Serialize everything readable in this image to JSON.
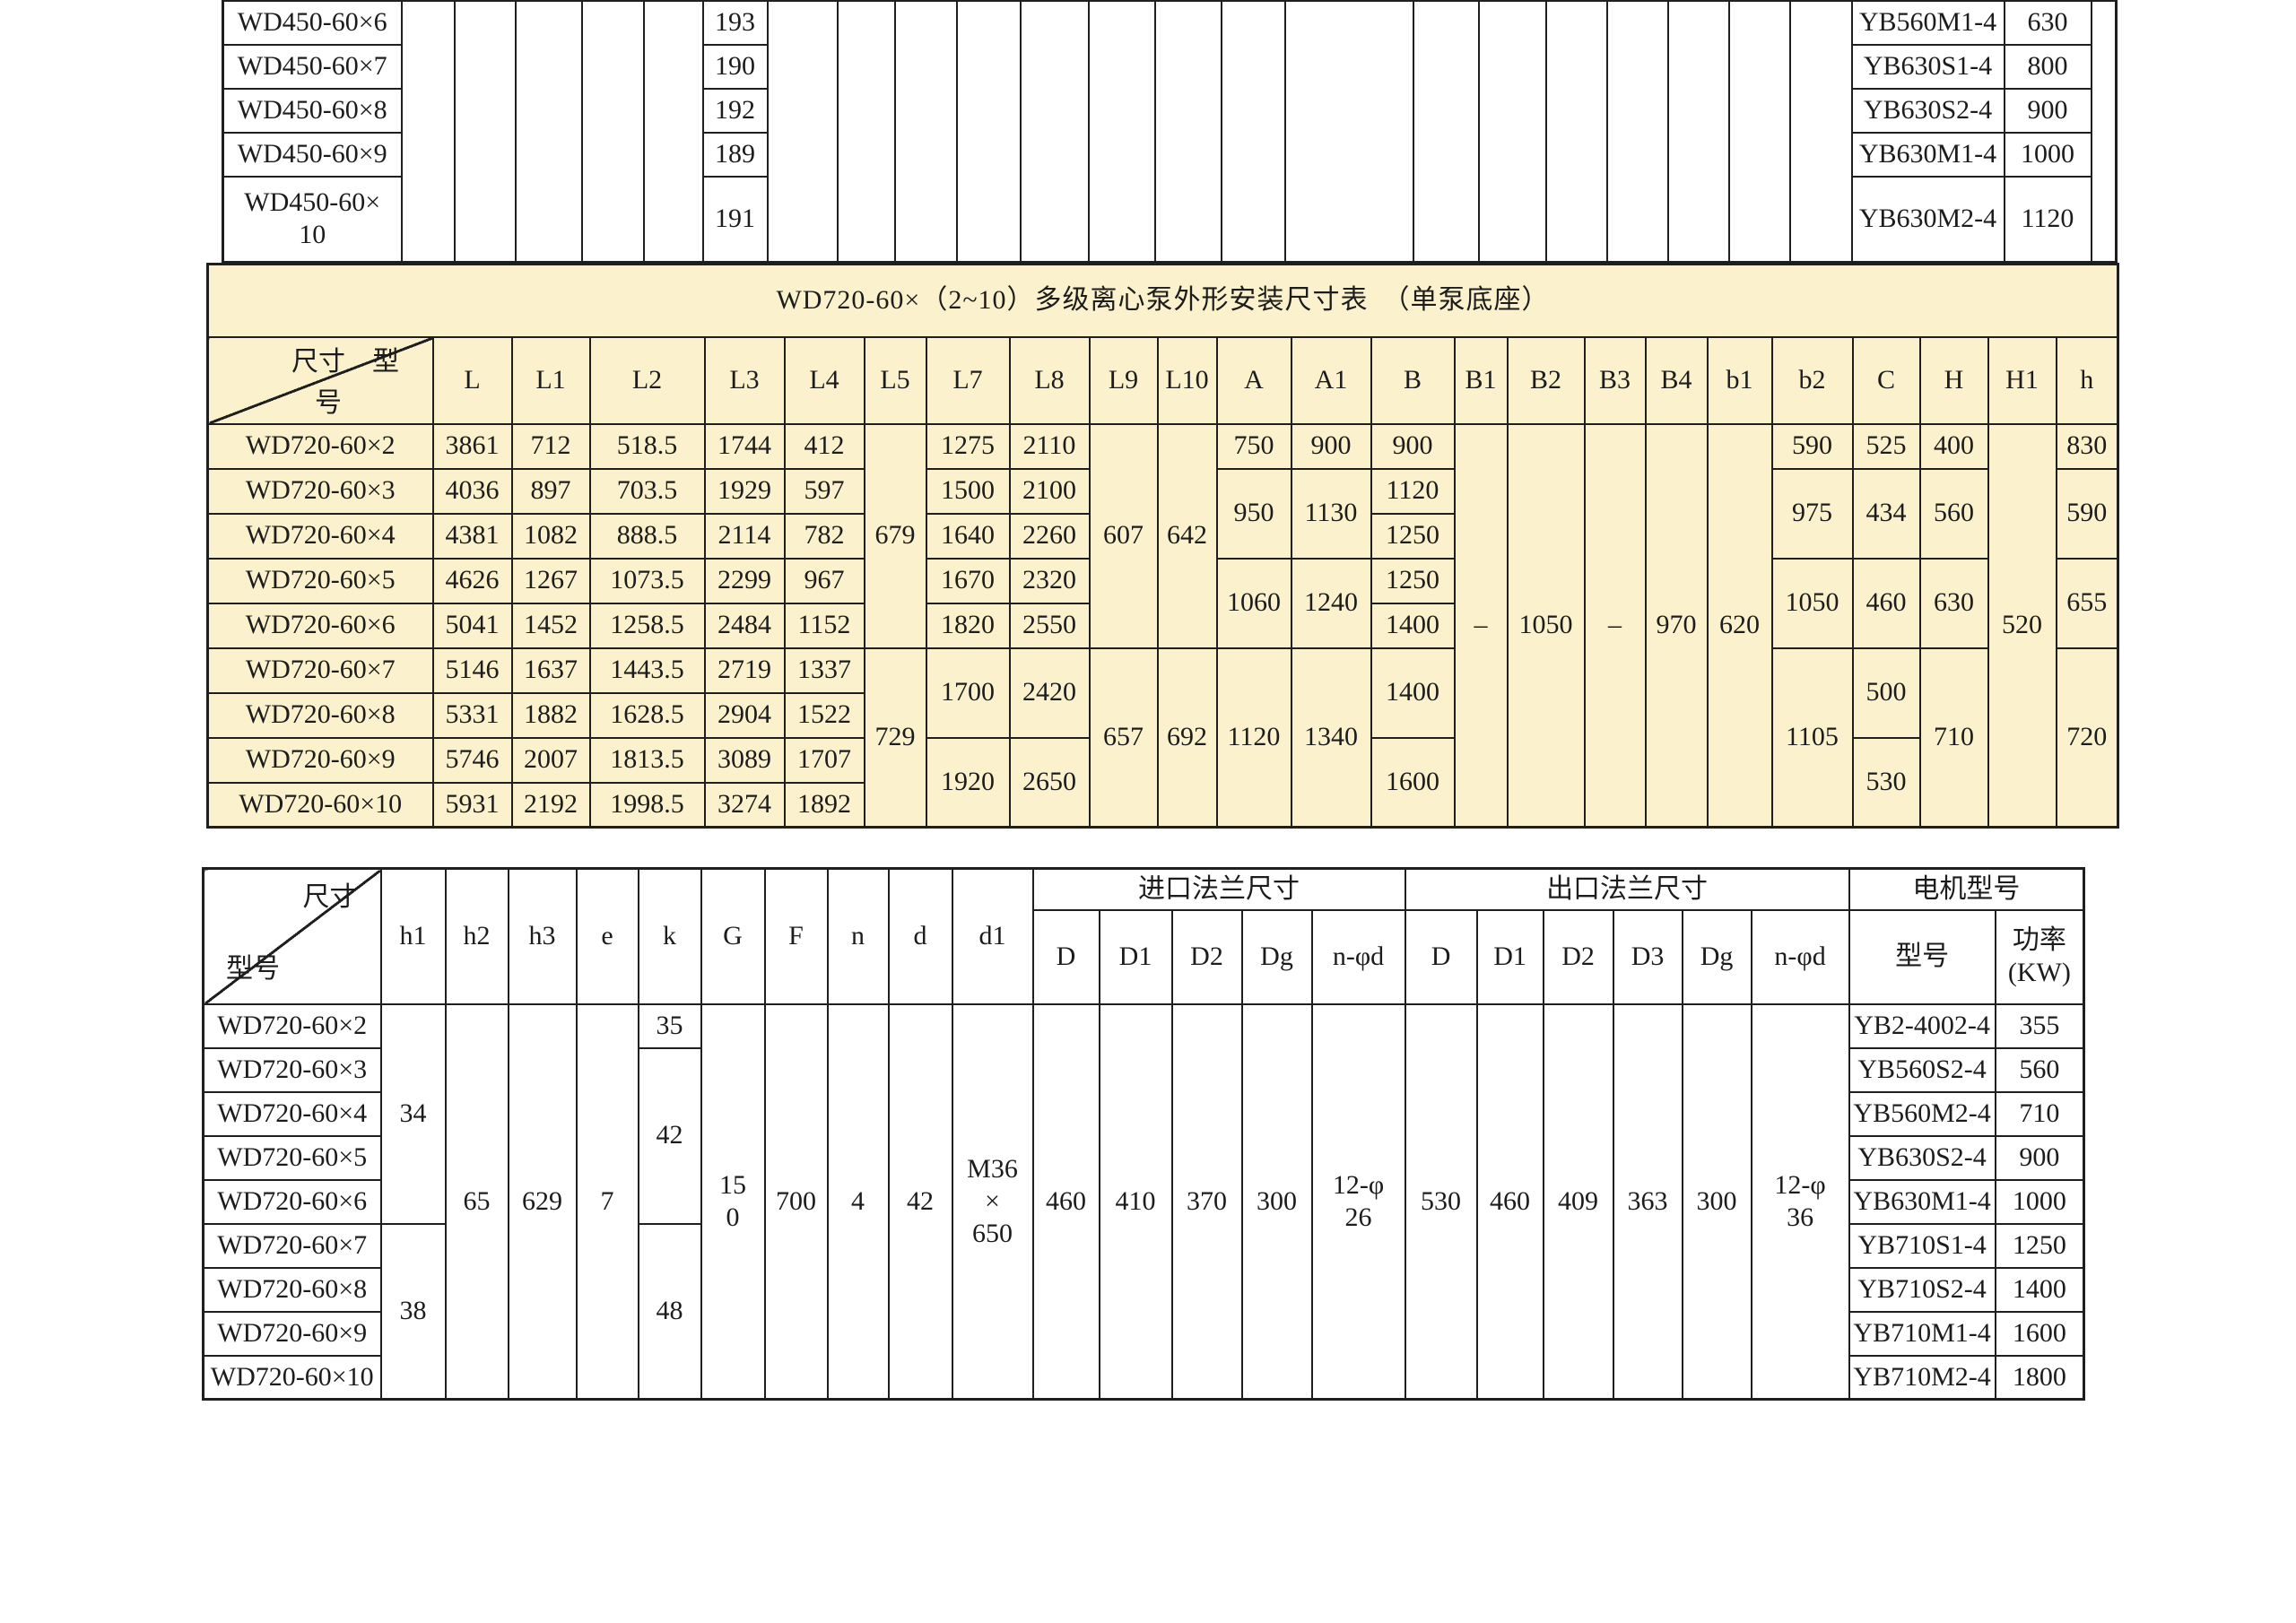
{
  "colors": {
    "table_fill": "#fbf2cd",
    "line": "#1f1f1f",
    "text": "#1c1c1c",
    "page_bg": "#ffffff"
  },
  "top_table": {
    "rows": [
      {
        "model_lines": [
          "WD450-60×6"
        ],
        "value": "193",
        "motor": "YB560M1-4",
        "power": "630"
      },
      {
        "model_lines": [
          "WD450-60×7"
        ],
        "value": "190",
        "motor": "YB630S1-4",
        "power": "800"
      },
      {
        "model_lines": [
          "WD450-60×8"
        ],
        "value": "192",
        "motor": "YB630S2-4",
        "power": "900"
      },
      {
        "model_lines": [
          "WD450-60×9"
        ],
        "value": "189",
        "motor": "YB630M1-4",
        "power": "1000"
      },
      {
        "model_lines": [
          "WD450-60×",
          "10"
        ],
        "value": "191",
        "motor": "YB630M2-4",
        "power": "1120"
      }
    ]
  },
  "pump": {
    "title": "WD720-60×（2~10）多级离心泵外形安装尺寸表　（单泵底座）",
    "corner_top": "尺寸　型",
    "corner_bottom": "号",
    "headers": [
      "L",
      "L1",
      "L2",
      "L3",
      "L4",
      "L5",
      "L7",
      "L8",
      "L9",
      "L10",
      "A",
      "A1",
      "B",
      "B1",
      "B2",
      "B3",
      "B4",
      "b1",
      "b2",
      "C",
      "H",
      "H1",
      "h"
    ],
    "models": [
      "WD720-60×2",
      "WD720-60×3",
      "WD720-60×4",
      "WD720-60×5",
      "WD720-60×6",
      "WD720-60×7",
      "WD720-60×8",
      "WD720-60×9",
      "WD720-60×10"
    ],
    "L": [
      "3861",
      "4036",
      "4381",
      "4626",
      "5041",
      "5146",
      "5331",
      "5746",
      "5931"
    ],
    "L1": [
      "712",
      "897",
      "1082",
      "1267",
      "1452",
      "1637",
      "1882",
      "2007",
      "2192"
    ],
    "L2": [
      "518.5",
      "703.5",
      "888.5",
      "1073.5",
      "1258.5",
      "1443.5",
      "1628.5",
      "1813.5",
      "1998.5"
    ],
    "L3": [
      "1744",
      "1929",
      "2114",
      "2299",
      "2484",
      "2719",
      "2904",
      "3089",
      "3274"
    ],
    "L4": [
      "412",
      "597",
      "782",
      "967",
      "1152",
      "1337",
      "1522",
      "1707",
      "1892"
    ],
    "L5": [
      "679",
      "729"
    ],
    "L7": [
      "1275",
      "1500",
      "1640",
      "1670",
      "1820",
      "1700",
      "1920"
    ],
    "L8": [
      "2110",
      "2100",
      "2260",
      "2320",
      "2550",
      "2420",
      "2650"
    ],
    "L9": [
      "607",
      "657"
    ],
    "L10": [
      "642",
      "692"
    ],
    "A": [
      "750",
      "950",
      "1060",
      "1120"
    ],
    "A1": [
      "900",
      "1130",
      "1240",
      "1340"
    ],
    "B": [
      "900",
      "1120",
      "1250",
      "1250",
      "1400",
      "1400",
      "1600"
    ],
    "B1": "–",
    "B2": "1050",
    "B3": "–",
    "B4": "970",
    "b1": "620",
    "b2": [
      "590",
      "975",
      "1050",
      "1105"
    ],
    "C": [
      "525",
      "434",
      "460",
      "500",
      "530"
    ],
    "H": [
      "400",
      "560",
      "630",
      "710"
    ],
    "H1": "520",
    "h": [
      "830",
      "590",
      "655",
      "720"
    ]
  },
  "install": {
    "corner_top": "尺寸",
    "corner_bottom": "型号",
    "dim_headers": [
      "h1",
      "h2",
      "h3",
      "e",
      "k",
      "G",
      "F",
      "n",
      "d",
      "d1"
    ],
    "inlet_group": "进口法兰尺寸",
    "inlet_headers": [
      "D",
      "D1",
      "D2",
      "Dg",
      "n-φd"
    ],
    "outlet_group": "出口法兰尺寸",
    "outlet_headers": [
      "D",
      "D1",
      "D2",
      "D3",
      "Dg",
      "n-φd"
    ],
    "motor_group": "电机型号",
    "motor_model_header": "型号",
    "motor_power_lines": [
      "功率",
      "(KW)"
    ],
    "models": [
      "WD720-60×2",
      "WD720-60×3",
      "WD720-60×4",
      "WD720-60×5",
      "WD720-60×6",
      "WD720-60×7",
      "WD720-60×8",
      "WD720-60×9",
      "WD720-60×10"
    ],
    "h1": [
      "34",
      "38"
    ],
    "h2": "65",
    "h3": "629",
    "e": "7",
    "k": [
      "35",
      "42",
      "48"
    ],
    "G_lines": [
      "15",
      "0"
    ],
    "F": "700",
    "n": "4",
    "d": "42",
    "d1_lines": [
      "M36",
      "×",
      "650"
    ],
    "inlet": {
      "D": "460",
      "D1": "410",
      "D2": "370",
      "Dg": "300",
      "nphid_lines": [
        "12-φ",
        "26"
      ]
    },
    "outlet": {
      "D": "530",
      "D1": "460",
      "D2": "409",
      "D3": "363",
      "Dg": "300",
      "nphid_lines": [
        "12-φ",
        "36"
      ]
    },
    "motors": [
      "YB2-4002-4",
      "YB560S2-4",
      "YB560M2-4",
      "YB630S2-4",
      "YB630M1-4",
      "YB710S1-4",
      "YB710S2-4",
      "YB710M1-4",
      "YB710M2-4"
    ],
    "powers": [
      "355",
      "560",
      "710",
      "900",
      "1000",
      "1250",
      "1400",
      "1600",
      "1800"
    ]
  }
}
